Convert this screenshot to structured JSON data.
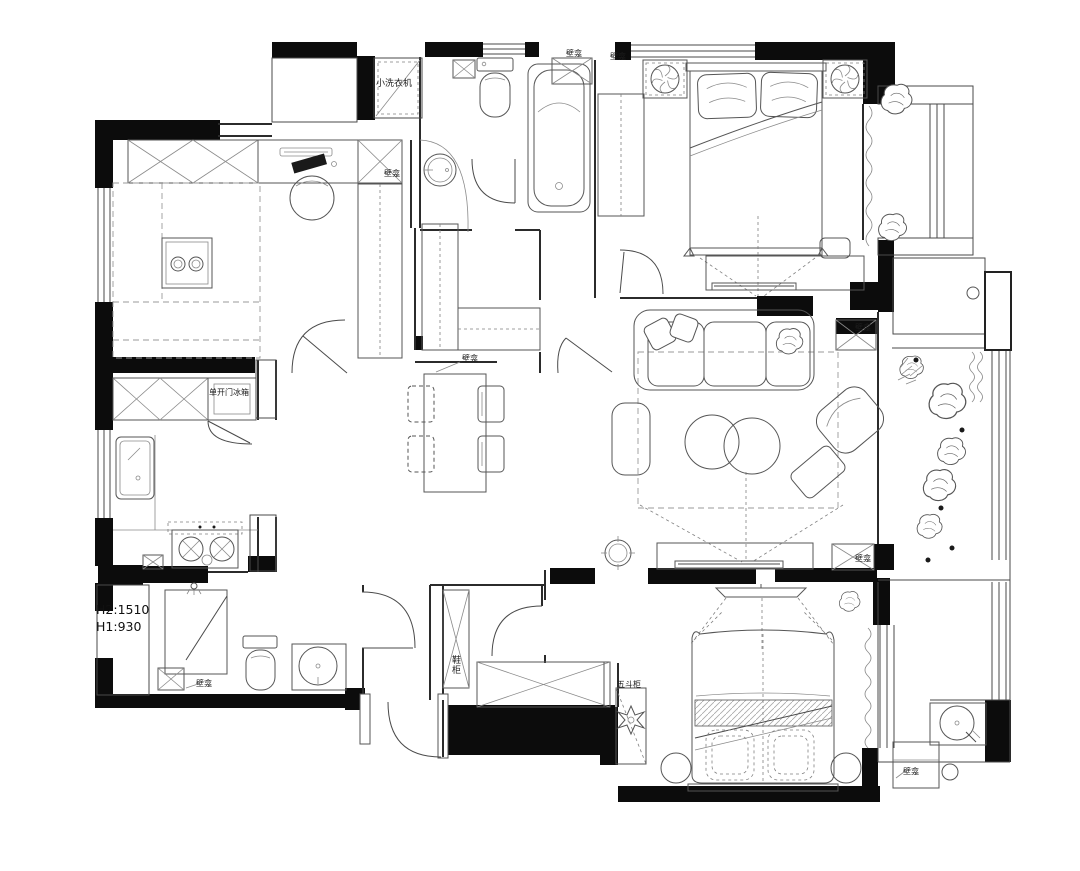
{
  "plan": {
    "type": "apartment-floor-plan",
    "labels": {
      "washing_machine": "小洗衣机",
      "fridge": "单开门冰箱",
      "niche": "壁龛",
      "shoe_cabinet": "鞋柜",
      "five_drawer_chest": "五斗柜",
      "height_h2": "H2:1510",
      "height_h1": "H1:930"
    },
    "colors": {
      "wall": "#0c0c0c",
      "line": "#555555",
      "background": "#ffffff"
    }
  }
}
